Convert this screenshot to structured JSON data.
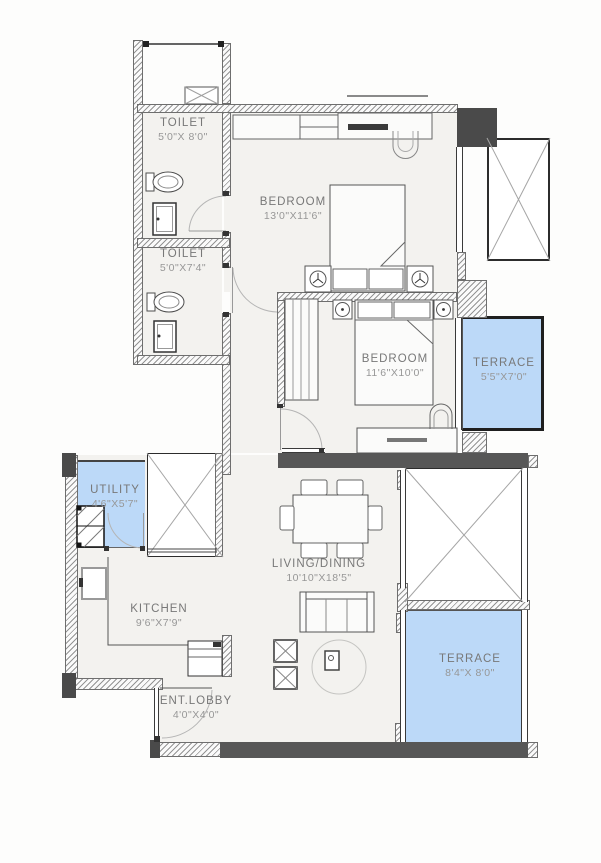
{
  "rooms": [
    {
      "id": "toilet-1",
      "name": "TOILET",
      "dims": "5'0\"X 8'0\""
    },
    {
      "id": "toilet-2",
      "name": "TOILET",
      "dims": "5'0\"X7'4\""
    },
    {
      "id": "bedroom-1",
      "name": "BEDROOM",
      "dims": "13'0\"X11'6\""
    },
    {
      "id": "bedroom-2",
      "name": "BEDROOM",
      "dims": "11'6\"X10'0\""
    },
    {
      "id": "terrace-1",
      "name": "TERRACE",
      "dims": "5'5\"X7'0\""
    },
    {
      "id": "utility",
      "name": "UTILITY",
      "dims": "4'6\"X5'7\""
    },
    {
      "id": "kitchen",
      "name": "KITCHEN",
      "dims": "9'6\"X7'9\""
    },
    {
      "id": "living-dining",
      "name": "LIVING/DINING",
      "dims": "10'10\"X18'5\""
    },
    {
      "id": "terrace-2",
      "name": "TERRACE",
      "dims": "8'4\"X 8'0\""
    },
    {
      "id": "ent-lobby",
      "name": "ENT.LOBBY",
      "dims": "4'0\"X4'0\""
    }
  ],
  "colors": {
    "terrace_fill": "#bcd9f8",
    "floor_fill": "#f3f2ef",
    "wall_dark": "#4a4a4a",
    "beam": "#575757",
    "label_text": "#787878"
  }
}
